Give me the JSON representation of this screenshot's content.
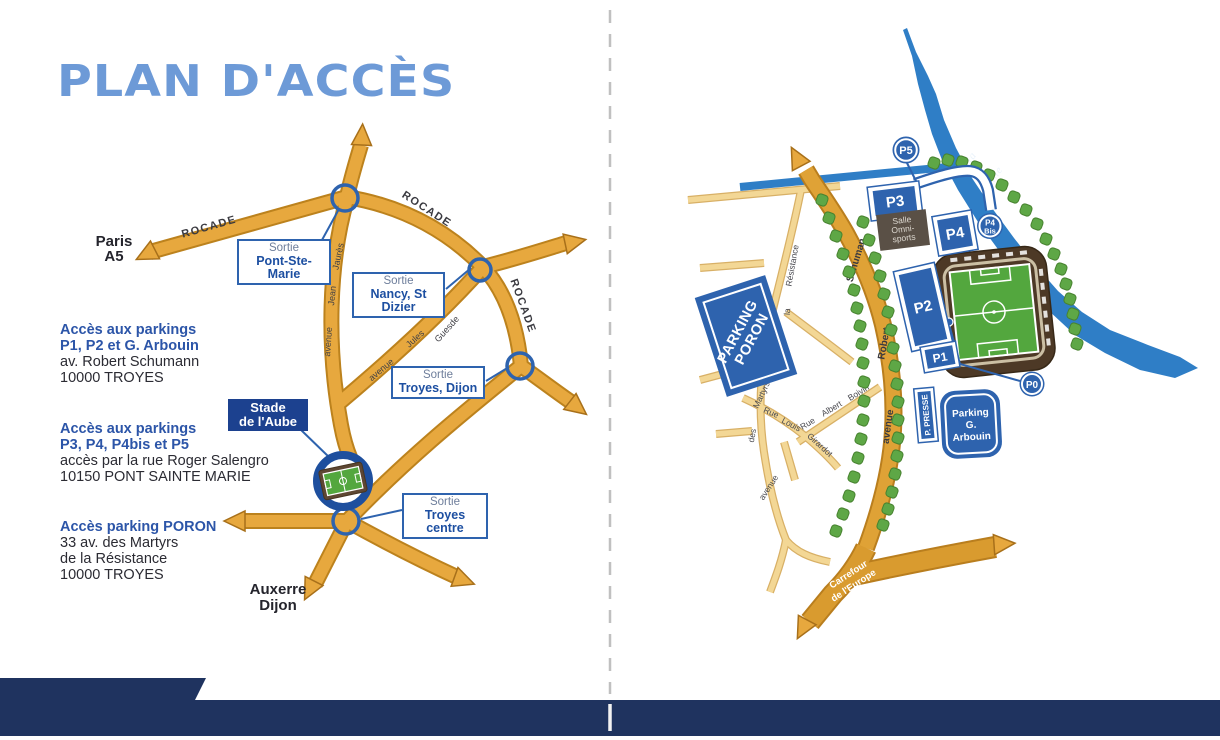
{
  "page": {
    "title": "PLAN D'ACCÈS"
  },
  "left_map": {
    "rocade": "ROCADE",
    "paris": {
      "line1": "Paris",
      "line2": "A5"
    },
    "auxerre": {
      "line1": "Auxerre",
      "line2": "Dijon"
    },
    "jaures": {
      "w1": "avenue",
      "w2": "Jean",
      "w3": "Jaurès"
    },
    "guesde": {
      "w1": "avenue",
      "w2": "Jules",
      "w3": "Guesde"
    },
    "exits": [
      {
        "prefix": "Sortie",
        "name": "Pont-Ste-Marie"
      },
      {
        "prefix": "Sortie",
        "name": "Nancy, St Dizier"
      },
      {
        "prefix": "Sortie",
        "name": "Troyes, Dijon"
      },
      {
        "prefix": "Sortie",
        "name": "Troyes centre"
      }
    ],
    "stadium": {
      "line1": "Stade",
      "line2": "de l'Aube"
    }
  },
  "access_info": {
    "block1": {
      "h1": "Accès aux parkings",
      "h2": "P1, P2 et G. Arbouin",
      "l1": "av. Robert Schumann",
      "l2": "10000 TROYES"
    },
    "block2": {
      "h1": "Accès aux parkings",
      "h2": "P3, P4, P4bis et P5",
      "l1": "accès par la rue Roger Salengro",
      "l2": "10150 PONT SAINTE MARIE"
    },
    "block3": {
      "h1": "Accès parking PORON",
      "l1": "33 av. des Martyrs",
      "l2": "de la Résistance",
      "l3": "10000 TROYES"
    }
  },
  "right_map": {
    "seine": {
      "w1": "la",
      "w2": "Seine"
    },
    "schuman": {
      "w1": "avenue",
      "w2": "Robert",
      "w3": "Schuman"
    },
    "martyrs": {
      "w1": "avenue",
      "w2": "des",
      "w3": "Martyrs",
      "w4": "de",
      "w5": "la",
      "w6": "Résistance"
    },
    "louis": {
      "w1": "Rue",
      "w2": "Louis",
      "w3": "Girardot"
    },
    "boivin": {
      "w1": "Rue",
      "w2": "Albert",
      "w3": "Boivin"
    },
    "carrefour": {
      "line1": "Carrefour",
      "line2": "de l'Europe"
    },
    "salle": {
      "line1": "Salle",
      "line2": "Omni-",
      "line3": "sports"
    },
    "parkings": {
      "p0": "P0",
      "p1": "P1",
      "p2": "P2",
      "p3": "P3",
      "p4": "P4",
      "p5": "P5",
      "p4bis": {
        "line1": "P4",
        "line2": "Bis"
      },
      "presse": "P. PRESSE",
      "poron": {
        "line1": "PARKING",
        "line2": "PORON"
      },
      "arbouin": {
        "line1": "Parking",
        "line2": "G.",
        "line3": "Arbouin"
      }
    }
  },
  "colors": {
    "title_blue": "#6D9AD7",
    "navy_bar": "#1F335F",
    "map_blue": "#2E63AE",
    "label_blue": "#1D4FA1",
    "stade_box_blue": "#1C418F",
    "road_gold": "#E7A83E",
    "road_light": "#F3D795",
    "river_blue": "#2F7EC6",
    "tree_green": "#5EA746",
    "heading_blue": "#2C55A8",
    "text_dark": "#2B2B33"
  }
}
